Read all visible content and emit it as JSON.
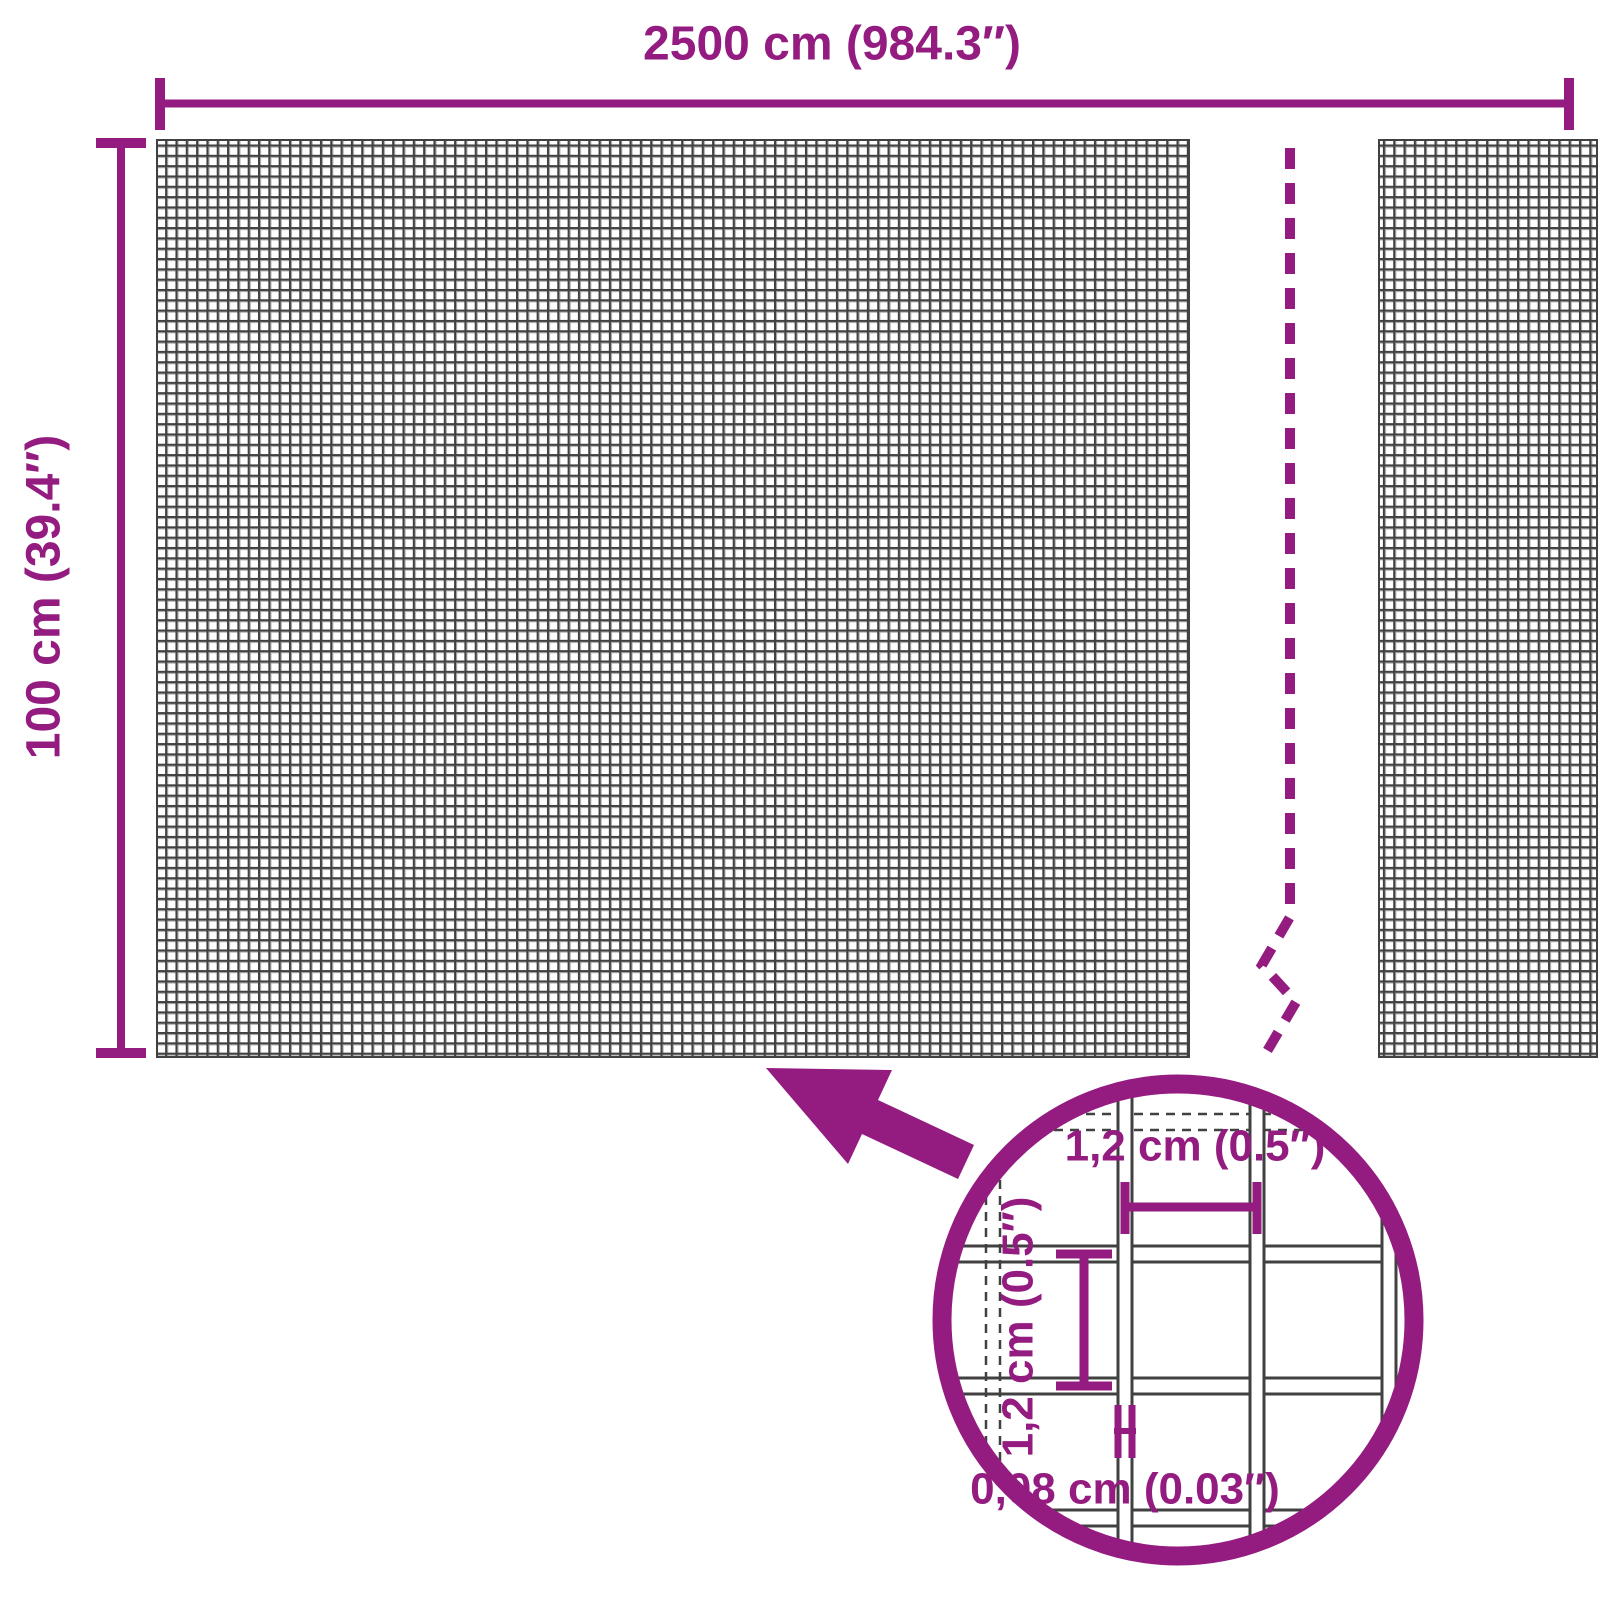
{
  "diagram": {
    "type": "product-dimension-diagram",
    "product": "wire mesh panel",
    "labels": {
      "total_width": "2500 cm (984.3″)",
      "total_height": "100 cm (39.4″)",
      "mesh_opening_width": "1,2 cm (0.5″)",
      "mesh_opening_height": "1,2 cm (0.5″)",
      "wire_thickness": "0,08 cm (0.03″)"
    },
    "colors": {
      "accent": "#941b80",
      "mesh_line": "#414141",
      "mesh_shade": "#a6a6a6",
      "background": "#ffffff"
    }
  }
}
